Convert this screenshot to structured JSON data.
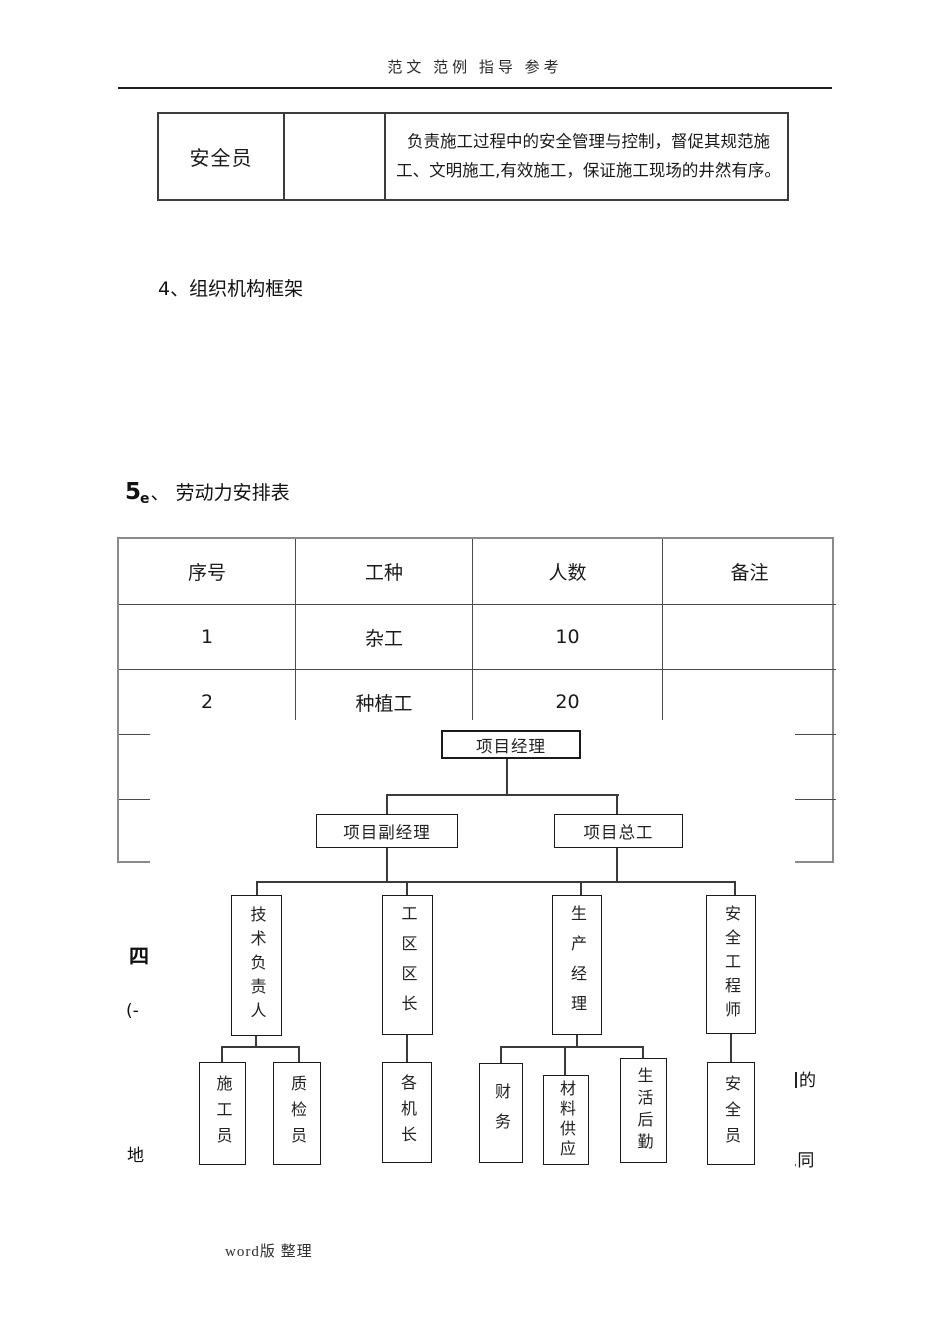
{
  "header": {
    "watermark": "范文 范例 指导 参考"
  },
  "footer": {
    "text": "word版 整理"
  },
  "duty_table": {
    "role": "安全员",
    "middle": "",
    "description": "负责施工过程中的安全管理与控制，督促其规范施工、文明施工,有效施工，保证施工现场的井然有序。"
  },
  "sections": {
    "s4": {
      "num": "4、",
      "title": "组织机构框架"
    },
    "s5": {
      "num": "5",
      "mark": "e",
      "sep": "、",
      "title": "劳动力安排表"
    }
  },
  "labor_table": {
    "headers": [
      "序号",
      "工种",
      "人数",
      "备注"
    ],
    "rows": [
      [
        "1",
        "杂工",
        "10",
        ""
      ],
      [
        "2",
        "种植工",
        "20",
        ""
      ],
      [
        "",
        "",
        "",
        ""
      ],
      [
        "",
        "",
        "",
        ""
      ]
    ]
  },
  "org_chart": {
    "level1": "项目经理",
    "level2": [
      "项目副经理",
      "项目总工"
    ],
    "level3": [
      "技术负责人",
      "工区区长",
      "生产经理",
      "安全工程师"
    ],
    "level4": [
      "施工员",
      "质检员",
      "各机长",
      "财务",
      "材料供应",
      "生活后勤",
      "安全员"
    ]
  },
  "margin_fragments": {
    "left_top": "四",
    "left_mid": "(-",
    "left_bottom": "地",
    "right_top": "的",
    "right_bottom": ",同"
  },
  "colors": {
    "ink": "#1a1a1a",
    "line": "#3a3a3a"
  }
}
